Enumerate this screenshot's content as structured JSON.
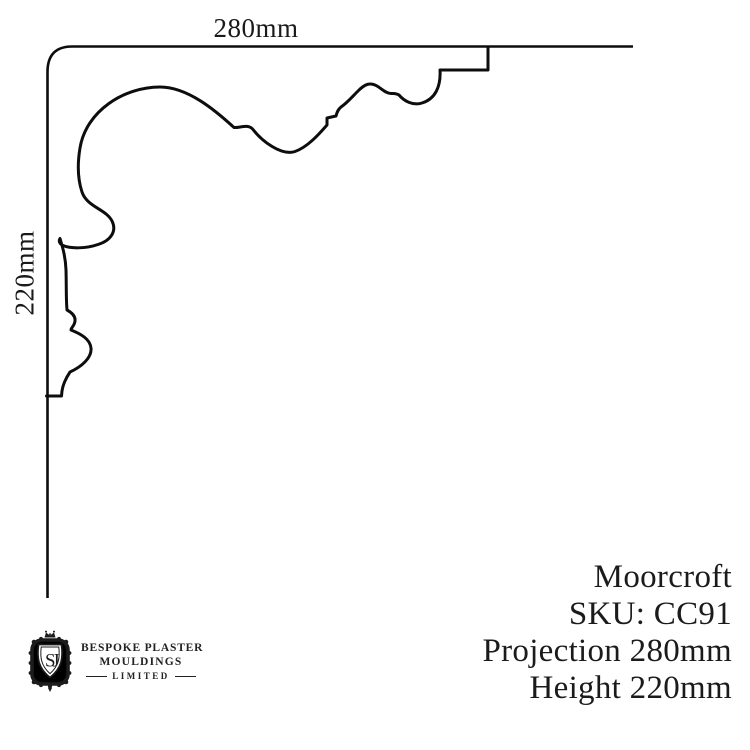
{
  "page": {
    "background": "#ffffff",
    "ink": "#0d0d0d"
  },
  "drawing": {
    "projection_label": "280mm",
    "height_label": "220mm"
  },
  "product": {
    "name": "Moorcroft",
    "sku": "SKU: CC91",
    "projection": "Projection 280mm",
    "height": "Height 220mm"
  },
  "logo": {
    "monogram": "SJ",
    "name_line1": "BESPOKE PLASTER",
    "name_line2": "MOULDINGS",
    "name_line3": "LIMITED"
  }
}
